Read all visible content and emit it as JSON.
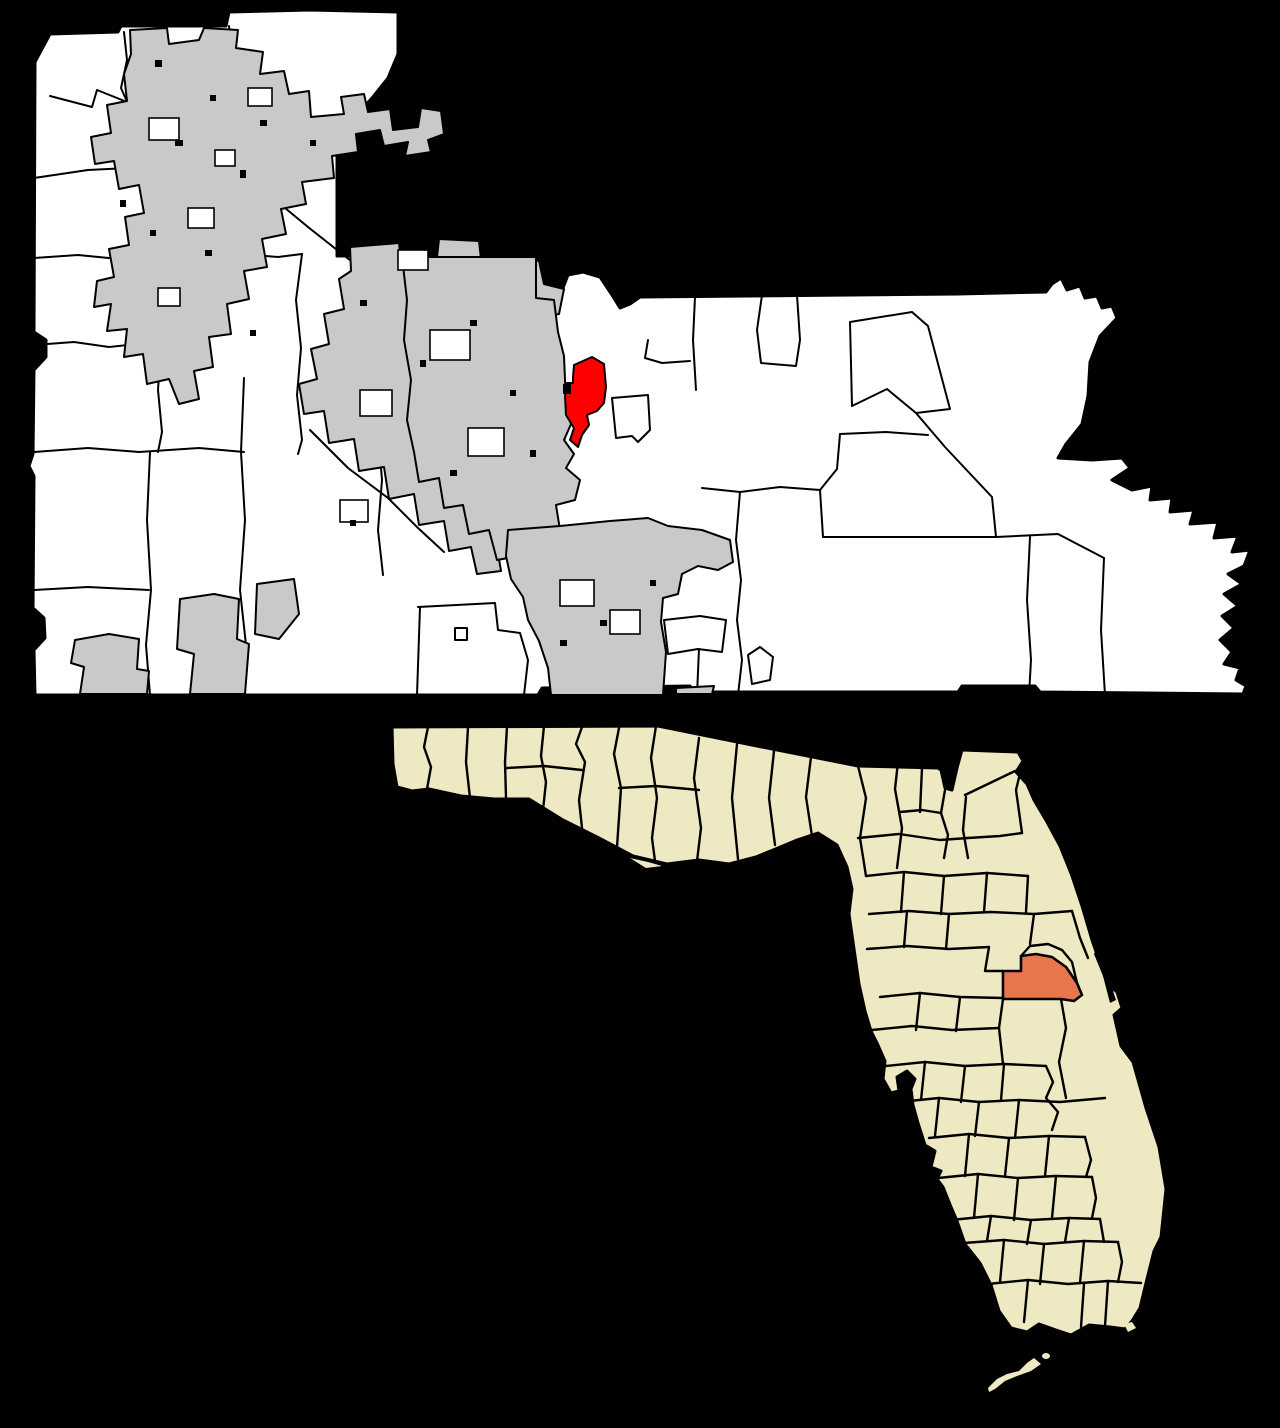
{
  "map": {
    "kind": "county-and-state-locator-map",
    "background_color": "#000000",
    "border_color": "#000000",
    "county_map": {
      "base_fill": "#ffffff",
      "urban_area_fill": "#c9c9c9",
      "highlighted_place_fill": "#ff0000"
    },
    "state_map": {
      "state_fill": "#eee8c3",
      "highlighted_county_fill": "#e8764c",
      "water_fill": "#000000"
    }
  }
}
